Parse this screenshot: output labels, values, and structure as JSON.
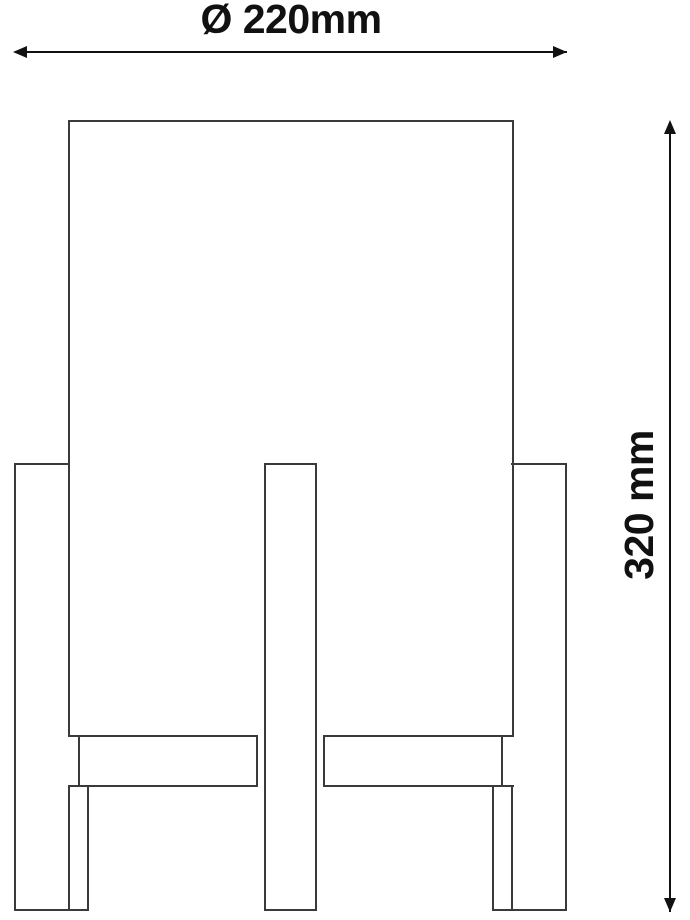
{
  "diagram": {
    "width_dimension": {
      "label": "Ø 220mm",
      "value_mm": 220
    },
    "height_dimension": {
      "label": "320 mm",
      "value_mm": 320
    },
    "colors": {
      "background": "#ffffff",
      "drawing_line": "#3a3a3a",
      "dimension_line": "#111111",
      "text": "#111111"
    }
  }
}
